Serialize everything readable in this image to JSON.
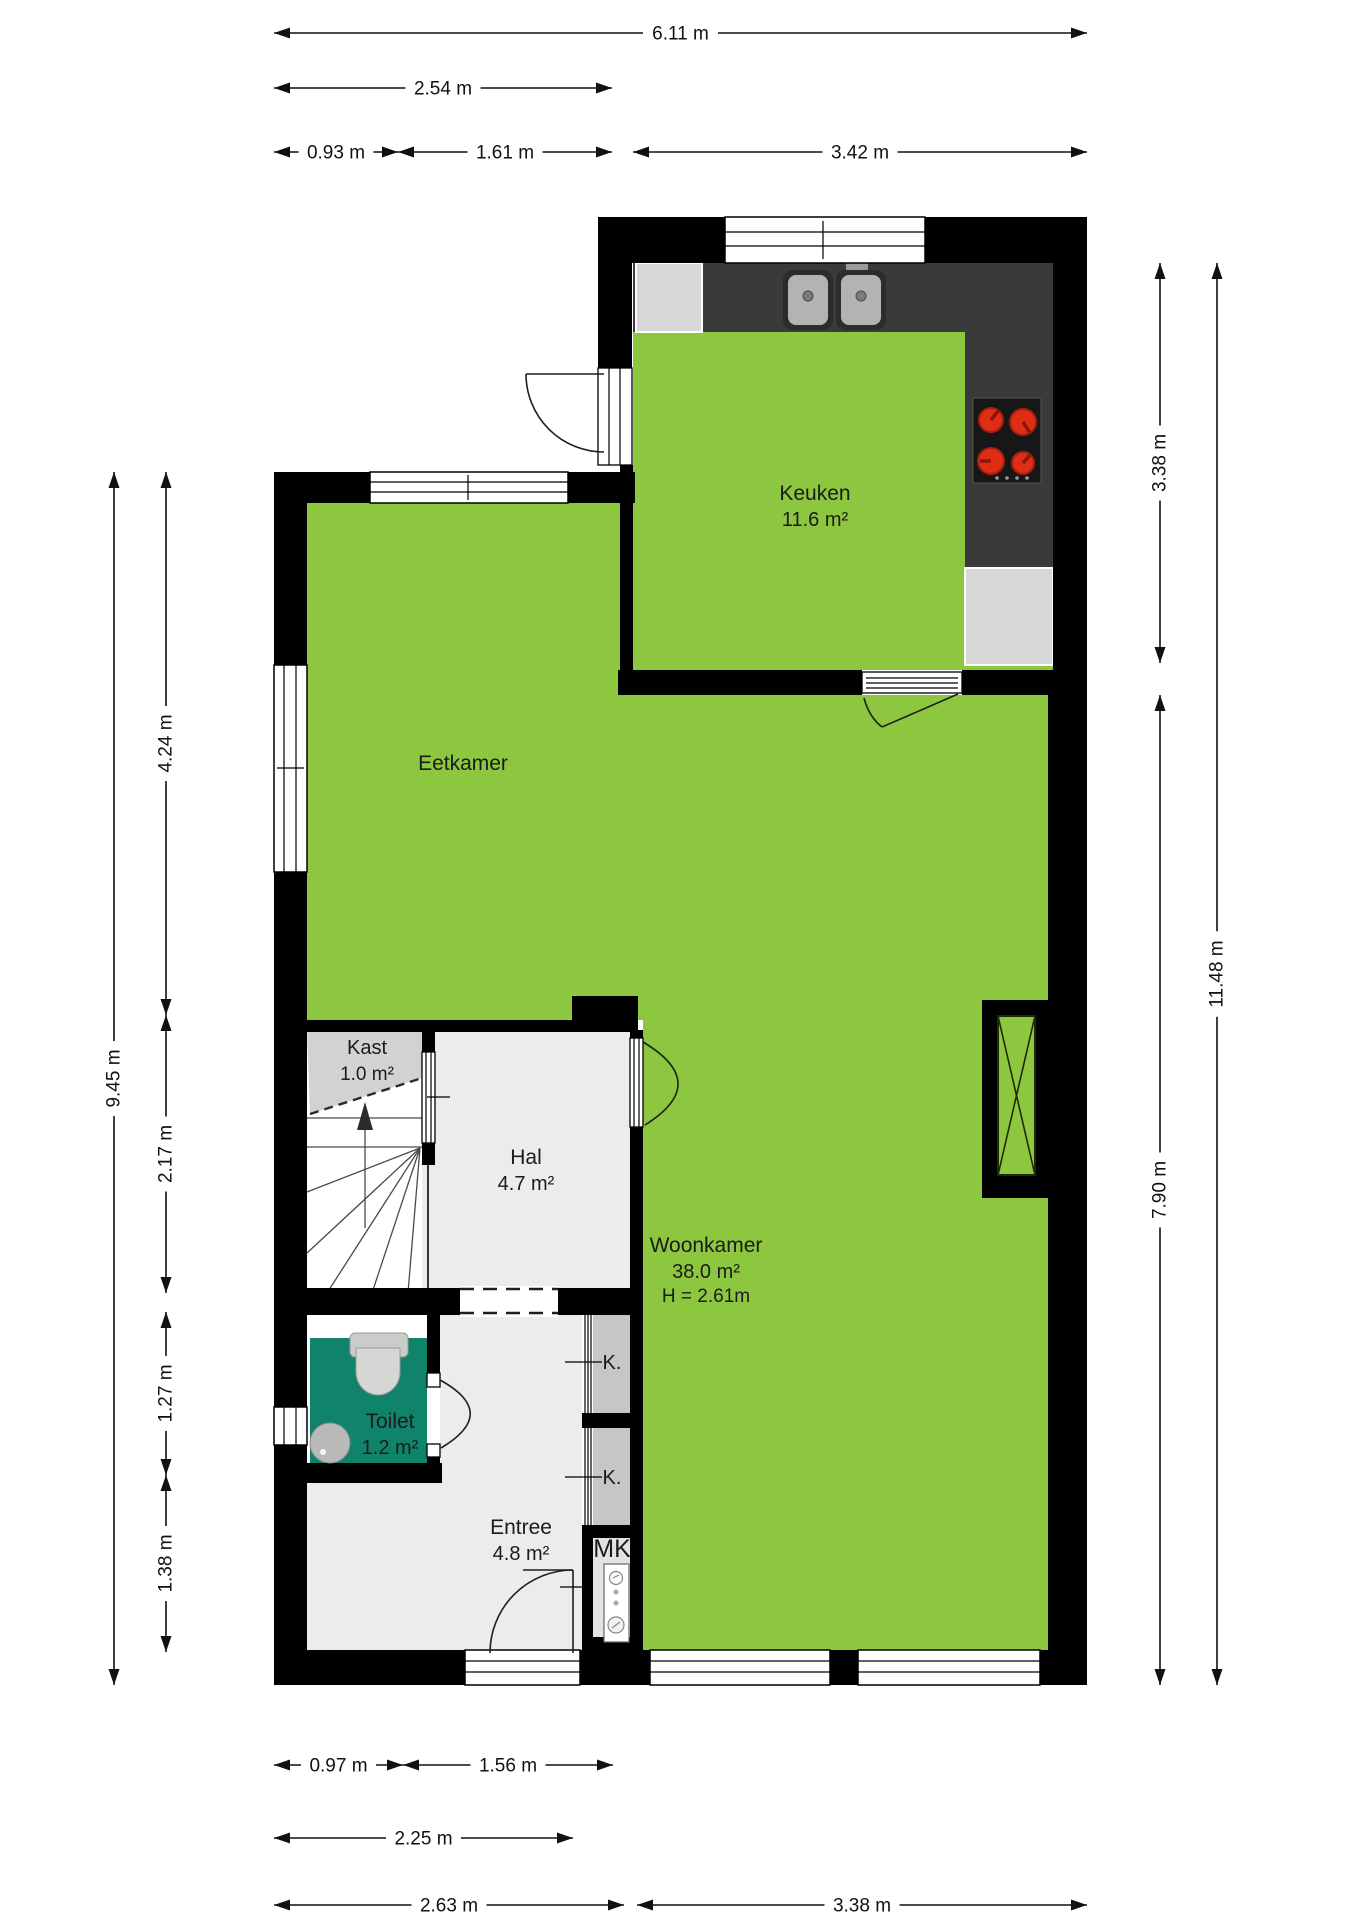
{
  "plan": {
    "title": "Begane grond plattegrond",
    "rooms": [
      {
        "name": "Keuken",
        "area": "11.6 m²",
        "label_x": 815,
        "label_y": 500
      },
      {
        "name": "Eetkamer",
        "area": "",
        "label_x": 463,
        "label_y": 770
      },
      {
        "name": "Kast",
        "area": "1.0 m²",
        "label_x": 367,
        "label_y": 1054,
        "small": true
      },
      {
        "name": "Hal",
        "area": "4.7 m²",
        "label_x": 526,
        "label_y": 1164
      },
      {
        "name": "Toilet",
        "area": "1.2 m²",
        "label_x": 390,
        "label_y": 1428
      },
      {
        "name": "Entree",
        "area": "4.8 m²",
        "label_x": 521,
        "label_y": 1534
      },
      {
        "name": "Woonkamer",
        "area": "38.0 m²",
        "height_note": "H = 2.61m",
        "label_x": 706,
        "label_y": 1252
      }
    ],
    "closet_labels": [
      {
        "text": "K.",
        "x": 612,
        "y": 1369
      },
      {
        "text": "K.",
        "x": 612,
        "y": 1484
      },
      {
        "text": "MK",
        "x": 612,
        "y": 1557,
        "big": true
      }
    ],
    "dimensions": {
      "top": [
        {
          "label": "6.11 m",
          "from": 274,
          "to": 1087,
          "at": 33
        },
        {
          "label": "2.54 m",
          "from": 274,
          "to": 612,
          "at": 88
        },
        {
          "label": "0.93 m",
          "from": 274,
          "to": 398,
          "at": 152
        },
        {
          "label": "1.61 m",
          "from": 398,
          "to": 612,
          "at": 152
        },
        {
          "label": "3.42 m",
          "from": 633,
          "to": 1087,
          "at": 152
        }
      ],
      "left": [
        {
          "label": "9.45 m",
          "from": 472,
          "to": 1685,
          "at": 114
        },
        {
          "label": "4.24 m",
          "from": 472,
          "to": 1015,
          "at": 166
        },
        {
          "label": "2.17 m",
          "from": 1015,
          "to": 1293,
          "at": 166
        },
        {
          "label": "1.27 m",
          "from": 1312,
          "to": 1475,
          "at": 166
        },
        {
          "label": "1.38 m",
          "from": 1475,
          "to": 1652,
          "at": 166
        }
      ],
      "right": [
        {
          "label": "3.38 m",
          "from": 263,
          "to": 663,
          "at": 1160
        },
        {
          "label": "11.48 m",
          "from": 263,
          "to": 1685,
          "at": 1217
        },
        {
          "label": "7.90 m",
          "from": 695,
          "to": 1685,
          "at": 1160
        }
      ],
      "bottom": [
        {
          "label": "0.97 m",
          "from": 274,
          "to": 403,
          "at": 1765
        },
        {
          "label": "1.56 m",
          "from": 403,
          "to": 613,
          "at": 1765
        },
        {
          "label": "2.25 m",
          "from": 274,
          "to": 573,
          "at": 1838
        },
        {
          "label": "2.63 m",
          "from": 274,
          "to": 624,
          "at": 1905
        },
        {
          "label": "3.38 m",
          "from": 637,
          "to": 1087,
          "at": 1905
        }
      ]
    },
    "colors": {
      "floor_green": "#8dc63f",
      "wall": "#000000",
      "counter": "#3a3a3a",
      "stove": "#171717",
      "burner": "#df2d16",
      "appliance": "#d7d7d6",
      "hall_floor": "#ececec",
      "kast_floor": "#d2d2d1",
      "closet_floor": "#c6c6c5",
      "toilet_floor": "#10836b",
      "mk_floor": "#e3e3e2",
      "text": "#1b1b1b"
    }
  }
}
